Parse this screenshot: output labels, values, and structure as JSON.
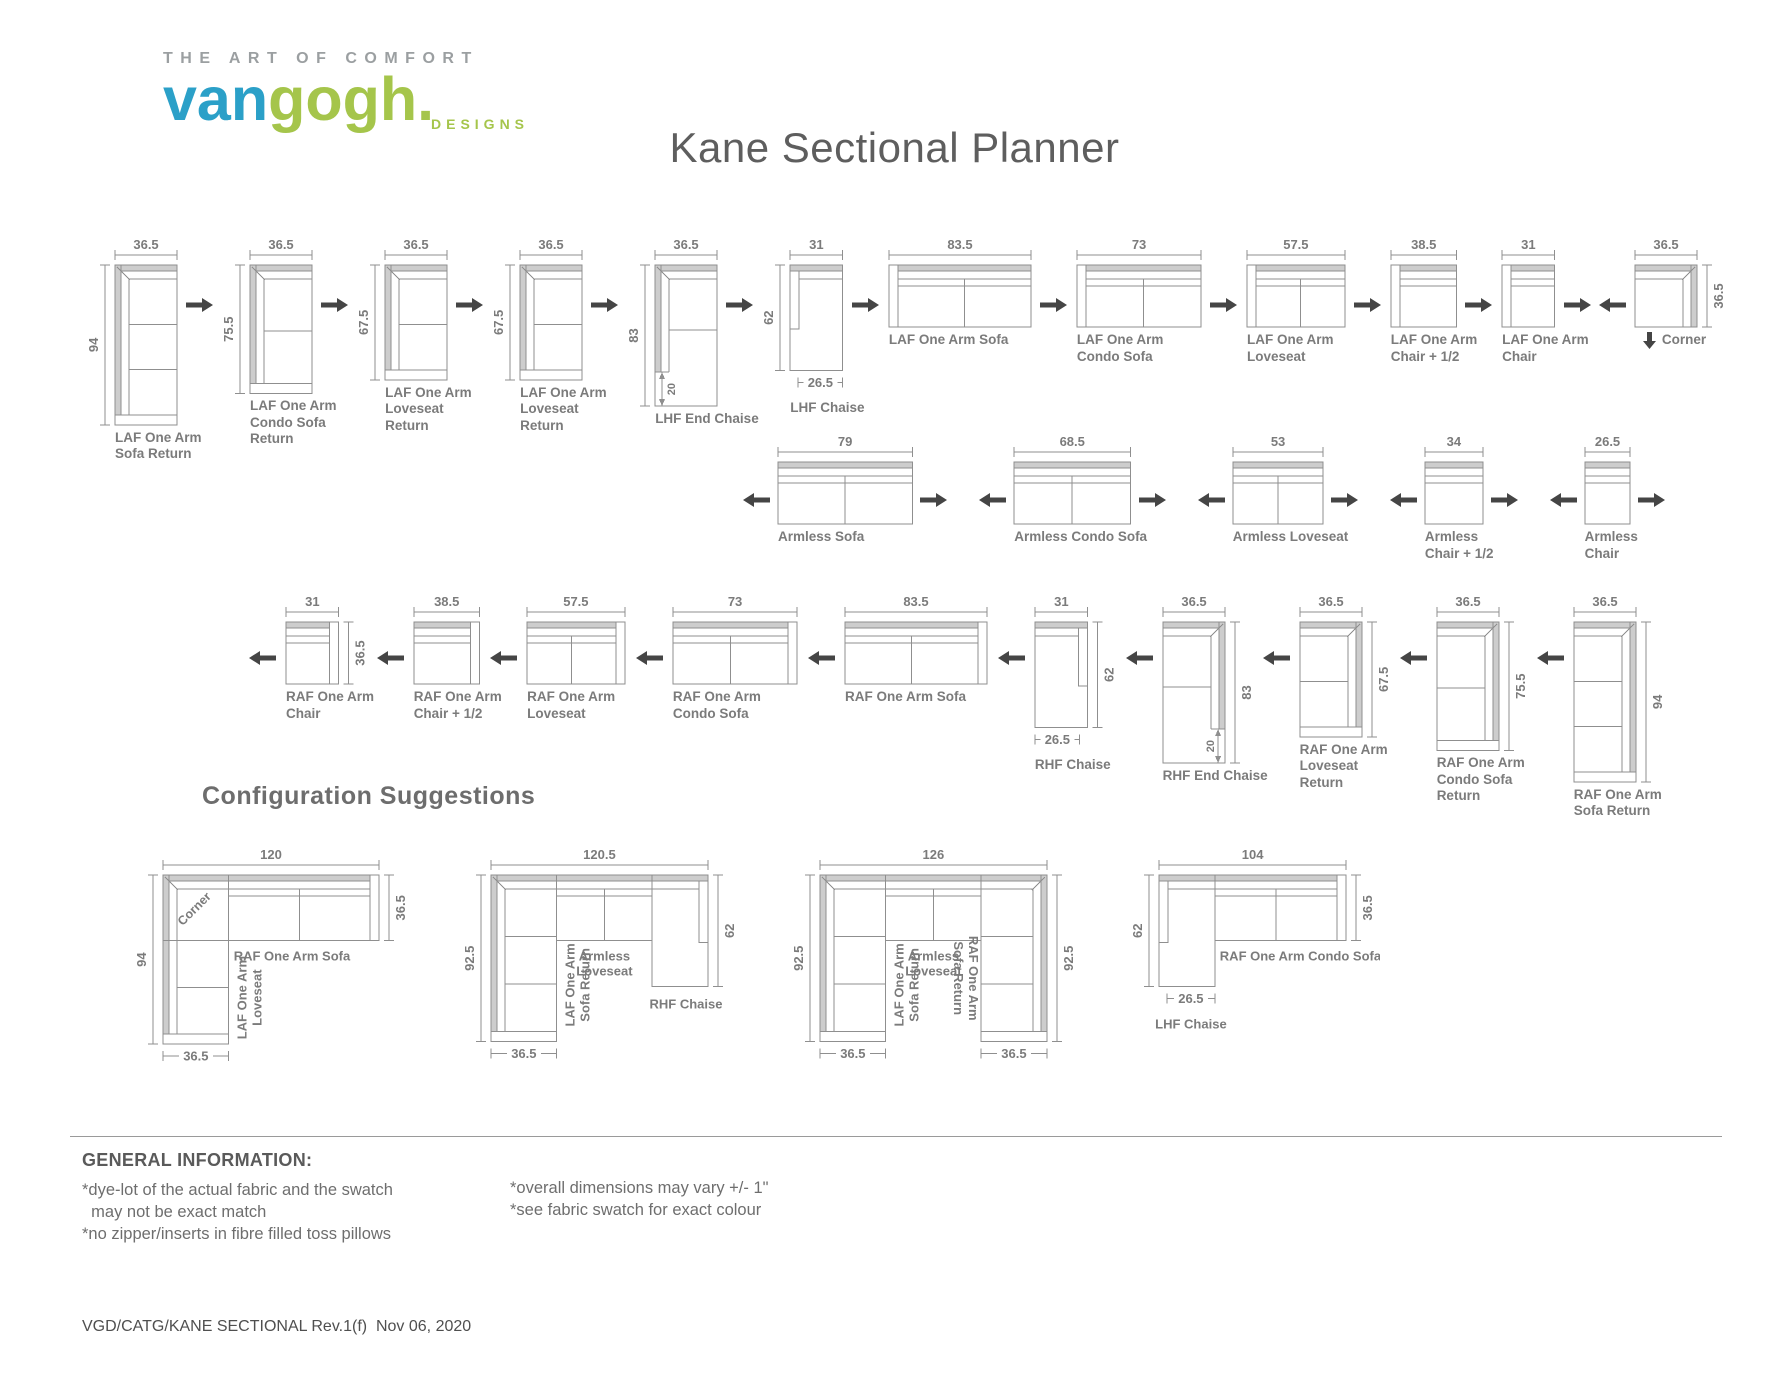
{
  "logo": {
    "tagline": "THE ART OF COMFORT",
    "van": "van",
    "gogh": "gogh",
    "dot": ".",
    "designs": "DESIGNS"
  },
  "title": "Kane Sectional Planner",
  "config_heading": "Configuration Suggestions",
  "colors": {
    "line": "#8f8f8f",
    "fill": "#cdcdcd",
    "label": "#7b7b7b",
    "arrow": "#454545",
    "logo_blue": "#2ba0c8",
    "logo_green": "#a5c54b"
  },
  "rows": [
    {
      "id": "row-laf",
      "pieces": [
        {
          "id": "laf-one-arm-sofa-return",
          "label": [
            "LAF One Arm",
            "Sofa Return"
          ],
          "kind": "return",
          "side": "left",
          "w": 36.5,
          "h": 94,
          "cushions": 3,
          "dims": {
            "top": "36.5",
            "left": "94"
          },
          "arrow_after": "right"
        },
        {
          "id": "laf-one-arm-condo-sofa-return",
          "label": [
            "LAF One Arm",
            "Condo Sofa",
            "Return"
          ],
          "kind": "return",
          "side": "left",
          "w": 36.5,
          "h": 75.5,
          "cushions": 2,
          "dims": {
            "top": "36.5",
            "left": "75.5"
          },
          "arrow_after": "right"
        },
        {
          "id": "laf-one-arm-loveseat-return",
          "label": [
            "LAF One Arm",
            "Loveseat",
            "Return"
          ],
          "kind": "return",
          "side": "left",
          "w": 36.5,
          "h": 67.5,
          "cushions": 2,
          "dims": {
            "top": "36.5",
            "left": "67.5"
          },
          "arrow_after": "right"
        },
        {
          "id": "laf-one-arm-loveseat-return-2",
          "label": [
            "LAF One Arm",
            "Loveseat",
            "Return"
          ],
          "kind": "return",
          "side": "left",
          "w": 36.5,
          "h": 67.5,
          "cushions": 2,
          "dims": {
            "top": "36.5",
            "left": "67.5"
          },
          "arrow_after": "right"
        },
        {
          "id": "lhf-end-chaise",
          "label": [
            "LHF End Chaise"
          ],
          "kind": "endchaise",
          "side": "left",
          "w": 36.5,
          "h": 83,
          "cushions": 2,
          "dims": {
            "top": "36.5",
            "left": "83",
            "inner": "20"
          },
          "arrow_after": "right"
        },
        {
          "id": "lhf-chaise",
          "label": [
            "LHF Chaise"
          ],
          "kind": "chaise",
          "side": "left",
          "w": 31,
          "h": 62,
          "dims": {
            "top": "31",
            "left": "62",
            "bottom": "26.5"
          },
          "arrow_after": "right"
        },
        {
          "id": "laf-one-arm-sofa",
          "label": [
            "LAF One Arm Sofa"
          ],
          "kind": "hsofa",
          "side": "left",
          "w": 83.5,
          "h": 36.5,
          "cushions": 2,
          "dims": {
            "top": "83.5"
          },
          "arrow_after": "right"
        },
        {
          "id": "laf-one-arm-condo-sofa",
          "label": [
            "LAF One Arm",
            "Condo Sofa"
          ],
          "kind": "hsofa",
          "side": "left",
          "w": 73,
          "h": 36.5,
          "cushions": 2,
          "dims": {
            "top": "73"
          },
          "arrow_after": "right"
        },
        {
          "id": "laf-one-arm-loveseat",
          "label": [
            "LAF One Arm",
            "Loveseat"
          ],
          "kind": "hsofa",
          "side": "left",
          "w": 57.5,
          "h": 36.5,
          "cushions": 2,
          "dims": {
            "top": "57.5"
          },
          "arrow_after": "right"
        },
        {
          "id": "laf-one-arm-chair-half",
          "label": [
            "LAF One Arm",
            "Chair + 1/2"
          ],
          "kind": "hsofa",
          "side": "left",
          "w": 38.5,
          "h": 36.5,
          "cushions": 1,
          "dims": {
            "top": "38.5"
          },
          "arrow_after": "right"
        },
        {
          "id": "laf-one-arm-chair",
          "label": [
            "LAF One Arm",
            "Chair"
          ],
          "kind": "hsofa",
          "side": "left",
          "w": 31,
          "h": 36.5,
          "cushions": 1,
          "dims": {
            "top": "31"
          },
          "arrow_after": "right"
        },
        {
          "id": "corner",
          "label": [
            "Corner"
          ],
          "kind": "corner",
          "w": 36.5,
          "h": 36.5,
          "dims": {
            "top": "36.5",
            "right": "36.5"
          },
          "arrow_before": "left",
          "label_arrow": "down"
        }
      ]
    },
    {
      "id": "row-armless",
      "pieces": [
        {
          "id": "armless-sofa",
          "label": [
            "Armless Sofa"
          ],
          "kind": "hsofa",
          "side": null,
          "w": 79,
          "h": 36.5,
          "cushions": 2,
          "dims": {
            "top": "79"
          },
          "arrow_before": "left",
          "arrow_after": "right"
        },
        {
          "id": "armless-condo-sofa",
          "label": [
            "Armless Condo Sofa"
          ],
          "kind": "hsofa",
          "side": null,
          "w": 68.5,
          "h": 36.5,
          "cushions": 2,
          "dims": {
            "top": "68.5"
          },
          "arrow_before": "left",
          "arrow_after": "right"
        },
        {
          "id": "armless-loveseat",
          "label": [
            "Armless Loveseat"
          ],
          "kind": "hsofa",
          "side": null,
          "w": 53,
          "h": 36.5,
          "cushions": 2,
          "dims": {
            "top": "53"
          },
          "arrow_before": "left",
          "arrow_after": "right"
        },
        {
          "id": "armless-chair-half",
          "label": [
            "Armless",
            "Chair + 1/2"
          ],
          "kind": "hsofa",
          "side": null,
          "w": 34,
          "h": 36.5,
          "cushions": 1,
          "dims": {
            "top": "34"
          },
          "arrow_before": "left",
          "arrow_after": "right"
        },
        {
          "id": "armless-chair",
          "label": [
            "Armless",
            "Chair"
          ],
          "kind": "hsofa",
          "side": null,
          "w": 26.5,
          "h": 36.5,
          "cushions": 1,
          "dims": {
            "top": "26.5"
          },
          "arrow_before": "left",
          "arrow_after": "right"
        }
      ]
    },
    {
      "id": "row-raf",
      "pieces": [
        {
          "id": "raf-one-arm-chair",
          "label": [
            "RAF One Arm",
            "Chair"
          ],
          "kind": "hsofa",
          "side": "right",
          "w": 31,
          "h": 36.5,
          "cushions": 1,
          "dims": {
            "top": "31",
            "right": "36.5"
          },
          "arrow_before": "left"
        },
        {
          "id": "raf-one-arm-chair-half",
          "label": [
            "RAF One Arm",
            "Chair + 1/2"
          ],
          "kind": "hsofa",
          "side": "right",
          "w": 38.5,
          "h": 36.5,
          "cushions": 1,
          "dims": {
            "top": "38.5"
          },
          "arrow_before": "left"
        },
        {
          "id": "raf-one-arm-loveseat",
          "label": [
            "RAF One Arm",
            "Loveseat"
          ],
          "kind": "hsofa",
          "side": "right",
          "w": 57.5,
          "h": 36.5,
          "cushions": 2,
          "dims": {
            "top": "57.5"
          },
          "arrow_before": "left"
        },
        {
          "id": "raf-one-arm-condo-sofa",
          "label": [
            "RAF One Arm",
            "Condo Sofa"
          ],
          "kind": "hsofa",
          "side": "right",
          "w": 73,
          "h": 36.5,
          "cushions": 2,
          "dims": {
            "top": "73"
          },
          "arrow_before": "left"
        },
        {
          "id": "raf-one-arm-sofa",
          "label": [
            "RAF One Arm Sofa"
          ],
          "kind": "hsofa",
          "side": "right",
          "w": 83.5,
          "h": 36.5,
          "cushions": 2,
          "dims": {
            "top": "83.5"
          },
          "arrow_before": "left"
        },
        {
          "id": "rhf-chaise",
          "label": [
            "RHF Chaise"
          ],
          "kind": "chaise",
          "side": "right",
          "w": 31,
          "h": 62,
          "dims": {
            "top": "31",
            "right": "62",
            "bottom": "26.5"
          },
          "arrow_before": "left"
        },
        {
          "id": "rhf-end-chaise",
          "label": [
            "RHF End Chaise"
          ],
          "kind": "endchaise",
          "side": "right",
          "w": 36.5,
          "h": 83,
          "cushions": 2,
          "dims": {
            "top": "36.5",
            "right": "83",
            "inner": "20"
          },
          "arrow_before": "left"
        },
        {
          "id": "raf-one-arm-loveseat-return",
          "label": [
            "RAF One Arm",
            "Loveseat",
            "Return"
          ],
          "kind": "return",
          "side": "right",
          "w": 36.5,
          "h": 67.5,
          "cushions": 2,
          "dims": {
            "top": "36.5",
            "right": "67.5"
          },
          "arrow_before": "left"
        },
        {
          "id": "raf-one-arm-condo-sofa-return",
          "label": [
            "RAF One Arm",
            "Condo Sofa",
            "Return"
          ],
          "kind": "return",
          "side": "right",
          "w": 36.5,
          "h": 75.5,
          "cushions": 2,
          "dims": {
            "top": "36.5",
            "right": "75.5"
          },
          "arrow_before": "left"
        },
        {
          "id": "raf-one-arm-sofa-return",
          "label": [
            "RAF One Arm",
            "Sofa Return"
          ],
          "kind": "return",
          "side": "right",
          "w": 36.5,
          "h": 94,
          "cushions": 3,
          "dims": {
            "top": "36.5",
            "right": "94"
          },
          "arrow_before": "left"
        }
      ]
    }
  ],
  "configs": [
    {
      "id": "config-corner-sofa-loveseat",
      "layout": "cornerL",
      "total_w": 120,
      "total_h": 94,
      "corner": 36.5,
      "depth": 36.5,
      "h_cushions": 2,
      "v_cushions": 2,
      "dims": {
        "top": "120",
        "left": "94",
        "right": "36.5",
        "bottom": "36.5"
      },
      "labels": {
        "corner": "Corner",
        "h": [
          "RAF One Arm Sofa"
        ],
        "v": [
          "LAF One Arm",
          "Loveseat"
        ]
      }
    },
    {
      "id": "config-return-loveseat-chaise",
      "layout": "rowL",
      "parts": {
        "ret_w": 36.5,
        "ls_w": 53,
        "ch_w": 31,
        "h": 92.5,
        "depth": 36.5,
        "ch_h": 62,
        "ret_cushions": 3,
        "ls_cushions": 2
      },
      "dims": {
        "top": "120.5",
        "left": "92.5",
        "right": "62",
        "bottom": "36.5"
      },
      "labels": {
        "left": [
          "LAF One Arm",
          "Sofa Return"
        ],
        "mid": [
          "Armless",
          "Loveseat"
        ],
        "right": [
          "RHF Chaise"
        ]
      }
    },
    {
      "id": "config-u-shape",
      "layout": "uShape",
      "parts": {
        "ret_w": 36.5,
        "ls_w": 53,
        "h": 92.5,
        "depth": 36.5,
        "ret_cushions": 3,
        "ls_cushions": 2
      },
      "dims": {
        "top": "126",
        "left": "92.5",
        "right": "92.5",
        "bottom_left": "36.5",
        "bottom_right": "36.5"
      },
      "labels": {
        "left": [
          "LAF One Arm",
          "Sofa Return"
        ],
        "mid": [
          "Armless",
          "Loveseat"
        ],
        "right": [
          "RAF One Arm",
          "Sofa Return"
        ]
      }
    },
    {
      "id": "config-chaise-condo",
      "layout": "chaiseL",
      "parts": {
        "ch_w": 31,
        "sofa_w": 73,
        "ch_h": 62,
        "depth": 36.5,
        "sofa_cushions": 2
      },
      "dims": {
        "top": "104",
        "left": "62",
        "right": "36.5",
        "bottom": "26.5"
      },
      "labels": {
        "left": [
          "LHF Chaise"
        ],
        "right": [
          "RAF One Arm Condo Sofa"
        ]
      }
    }
  ],
  "general_info": {
    "heading": "GENERAL INFORMATION:",
    "left_notes": [
      "*dye-lot of the actual fabric and the swatch",
      "  may not be exact match",
      "*no zipper/inserts in fibre filled toss pillows"
    ],
    "right_notes": [
      "*overall dimensions may vary +/- 1\"",
      "*see fabric swatch for exact colour"
    ]
  },
  "footer": "VGD/CATG/KANE SECTIONAL Rev.1(f)  Nov 06, 2020"
}
